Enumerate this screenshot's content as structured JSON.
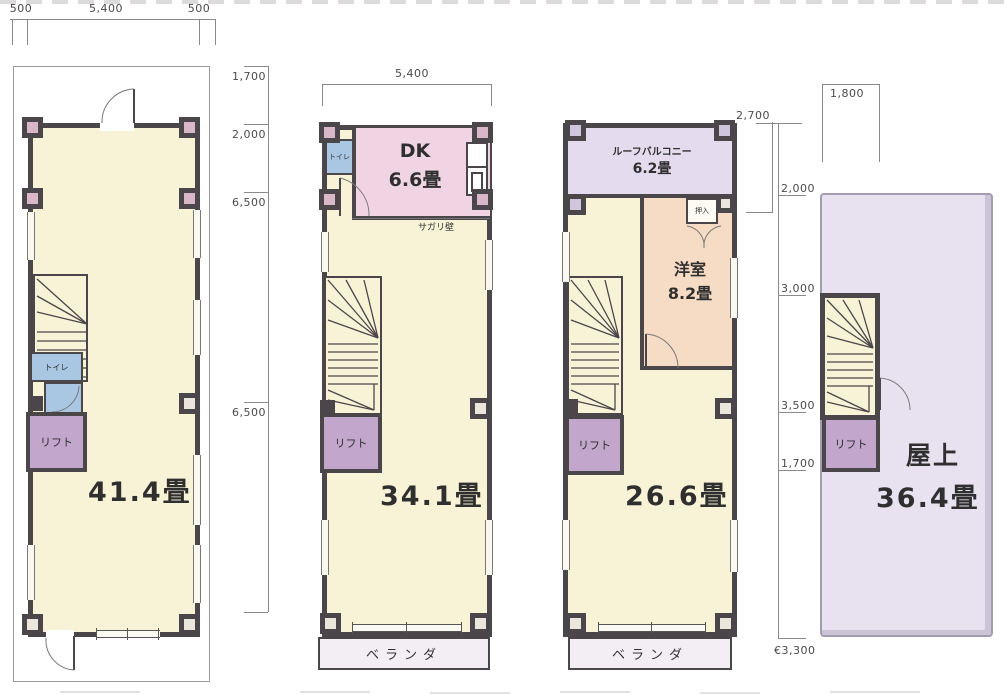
{
  "sheet": {
    "type": "floor-plan-drawing"
  },
  "colors": {
    "wall": "#4b464a",
    "room_cream": "#f8f3d7",
    "dk_pink": "#f0d4e3",
    "toilet_blue": "#a9c6e3",
    "lift_purple": "#c2a6cb",
    "balcony_lavender": "#e4dcee",
    "western_peach": "#f6dcc4",
    "veranda": "#f3eef4",
    "roof": "#e8e1f0",
    "dim_text": "#4a4a4a"
  },
  "dims": {
    "plan1_top": [
      "500",
      "5,400",
      "500"
    ],
    "plan1_right": [
      "1,700",
      "2,000",
      "6,500",
      "6,500"
    ],
    "plan2_top": "5,400",
    "plan3_top": "2,700",
    "plan4_top": "1,800",
    "right_chain": [
      "2,000",
      "3,000",
      "3,500",
      "1,700"
    ],
    "right_chain_bottom": "€3,300"
  },
  "plan1": {
    "area": "41.4畳",
    "toilet": "トイレ",
    "lift": "リフト"
  },
  "plan2": {
    "area": "34.1畳",
    "dk": "DK",
    "dk_area": "6.6畳",
    "toilet": "トイレ",
    "sagari_wall": "サガリ壁",
    "lift": "リフト",
    "veranda": "ベランダ"
  },
  "plan3": {
    "area": "26.6畳",
    "balcony": "ルーフバルコニー",
    "balcony_area": "6.2畳",
    "closet": "押入",
    "western_room": "洋室",
    "western_room_area": "8.2畳",
    "lift": "リフト",
    "veranda": "ベランダ"
  },
  "plan4": {
    "title": "屋上",
    "area": "36.4畳",
    "lift": "リフト"
  }
}
